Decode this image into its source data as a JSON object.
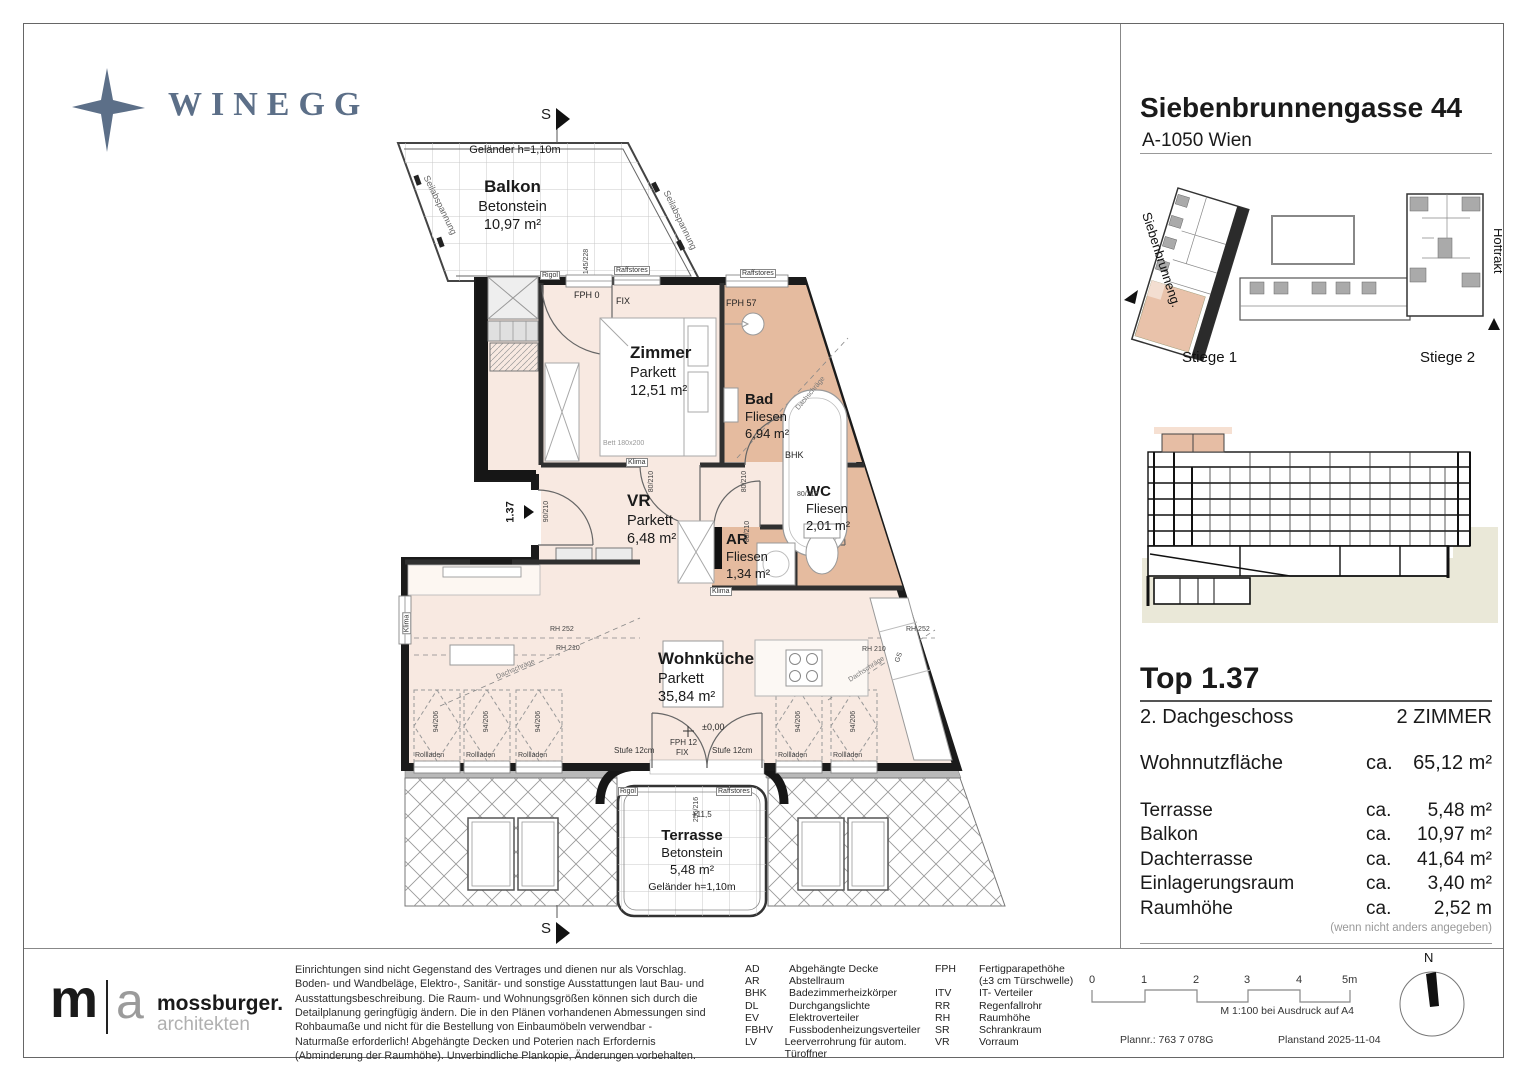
{
  "brand": {
    "logo_text": "WINEGG"
  },
  "header": {
    "title": "Siebenbrunnengasse 44",
    "subtitle": "A-1050 Wien"
  },
  "site_plan": {
    "stiege1": "Stiege 1",
    "stiege2": "Stiege 2",
    "street": "Siebenbrunneng.",
    "hoftrakt": "Hoftrakt"
  },
  "unit": {
    "top": "Top 1.37",
    "floor": "2. Dachgeschoss",
    "rooms": "2 ZIMMER",
    "main": {
      "label": "Wohnnutzfläche",
      "ca": "ca.",
      "value": "65,12 m²"
    },
    "areas": [
      {
        "label": "Terrasse",
        "ca": "ca.",
        "value": "5,48 m²"
      },
      {
        "label": "Balkon",
        "ca": "ca.",
        "value": "10,97 m²"
      },
      {
        "label": "Dachterrasse",
        "ca": "ca.",
        "value": "41,64 m²"
      },
      {
        "label": "Einlagerungsraum",
        "ca": "ca.",
        "value": "3,40 m²"
      },
      {
        "label": "Raumhöhe",
        "ca": "ca.",
        "value": "2,52 m"
      }
    ],
    "note": "(wenn nicht anders angegeben)"
  },
  "plan": {
    "balkon": {
      "name": "Balkon",
      "floor": "Betonstein",
      "area": "10,97 m²",
      "railing": "Geländer h=1,10m",
      "cable": "Seilabspannung"
    },
    "zimmer": {
      "name": "Zimmer",
      "floor": "Parkett",
      "area": "12,51 m²",
      "bed": "Bett 180x200"
    },
    "bad": {
      "name": "Bad",
      "floor": "Fliesen",
      "area": "6,94 m²"
    },
    "wc": {
      "name": "WC",
      "floor": "Fliesen",
      "area": "2,01 m²"
    },
    "ar": {
      "name": "AR",
      "floor": "Fliesen",
      "area": "1,34 m²"
    },
    "vr": {
      "name": "VR",
      "floor": "Parkett",
      "area": "6,48 m²"
    },
    "kueche": {
      "name": "Wohnküche",
      "floor": "Parkett",
      "area": "35,84 m²"
    },
    "terrasse": {
      "name": "Terrasse",
      "floor": "Betonstein",
      "area": "5,48 m²",
      "railing": "Geländer h=1,10m",
      "level": "+11,5"
    },
    "marks": {
      "section": "S",
      "unit_no": "1.37",
      "fph0": "FPH 0",
      "fix": "FIX",
      "fph57": "FPH 57",
      "fph12": "FPH 12",
      "rigol": "Rigol",
      "raffstores": "Raffstores",
      "stufe": "Stufe 12cm",
      "level0": "±0,00",
      "bhk": "BHK",
      "klima": "Klima",
      "rollladen": "Rollladen",
      "rh252": "RH 252",
      "rh210": "RH 210",
      "dachschraege": "Dachschräge",
      "gs": "GS",
      "bett": "Bett 180x200",
      "d145": "145/228",
      "d80": "80/210",
      "d90": "90/210",
      "d94": "94/206",
      "d256": "256/216"
    }
  },
  "footer": {
    "architect": {
      "m": "m",
      "a": "a",
      "name": "mossburger.",
      "sub": "architekten"
    },
    "disclaimer": "Einrichtungen sind nicht Gegenstand des Vertrages und dienen nur als Vorschlag. Boden- und Wandbeläge, Elektro-, Sanitär- und sonstige Ausstattungen laut Bau- und Ausstattungsbeschreibung. Die Raum- und Wohnungsgrößen können sich durch die Detailplanung geringfügig ändern. Die in den Plänen vorhandenen Abmessungen sind Rohbaumaße und nicht für die Bestellung von Einbaumöbeln verwendbar - Naturmaße erforderlich! Abgehängte Decken und Poterien nach Erfordernis (Abminderung der Raumhöhe). Unverbindliche Plankopie, Änderungen vorbehalten.",
    "legend_left": [
      {
        "abbr": "AD",
        "label": "Abgehängte Decke"
      },
      {
        "abbr": "AR",
        "label": "Abstellraum"
      },
      {
        "abbr": "BHK",
        "label": "Badezimmerheizkörper"
      },
      {
        "abbr": "DL",
        "label": "Durchgangslichte"
      },
      {
        "abbr": "EV",
        "label": "Elektroverteiler"
      },
      {
        "abbr": "FBHV",
        "label": "Fussbodenheizungsverteiler"
      },
      {
        "abbr": "LV",
        "label": "Leerverrohrung für autom. Türoffner"
      }
    ],
    "legend_right": [
      {
        "abbr": "FPH",
        "label": "Fertigparapethöhe"
      },
      {
        "abbr": "",
        "label": "(±3 cm Türschwelle)"
      },
      {
        "abbr": "ITV",
        "label": "IT- Verteiler"
      },
      {
        "abbr": "RR",
        "label": "Regenfallrohr"
      },
      {
        "abbr": "RH",
        "label": "Raumhöhe"
      },
      {
        "abbr": "SR",
        "label": "Schrankraum"
      },
      {
        "abbr": "VR",
        "label": "Vorraum"
      }
    ],
    "scale": {
      "t0": "0",
      "t1": "1",
      "t2": "2",
      "t3": "3",
      "t4": "4",
      "t5": "5m",
      "note": "M 1:100 bei Ausdruck auf A4"
    },
    "plan_no": "Plannr.: 763 7 078G",
    "plan_date": "Planstand 2025-11-04",
    "north": "N"
  }
}
